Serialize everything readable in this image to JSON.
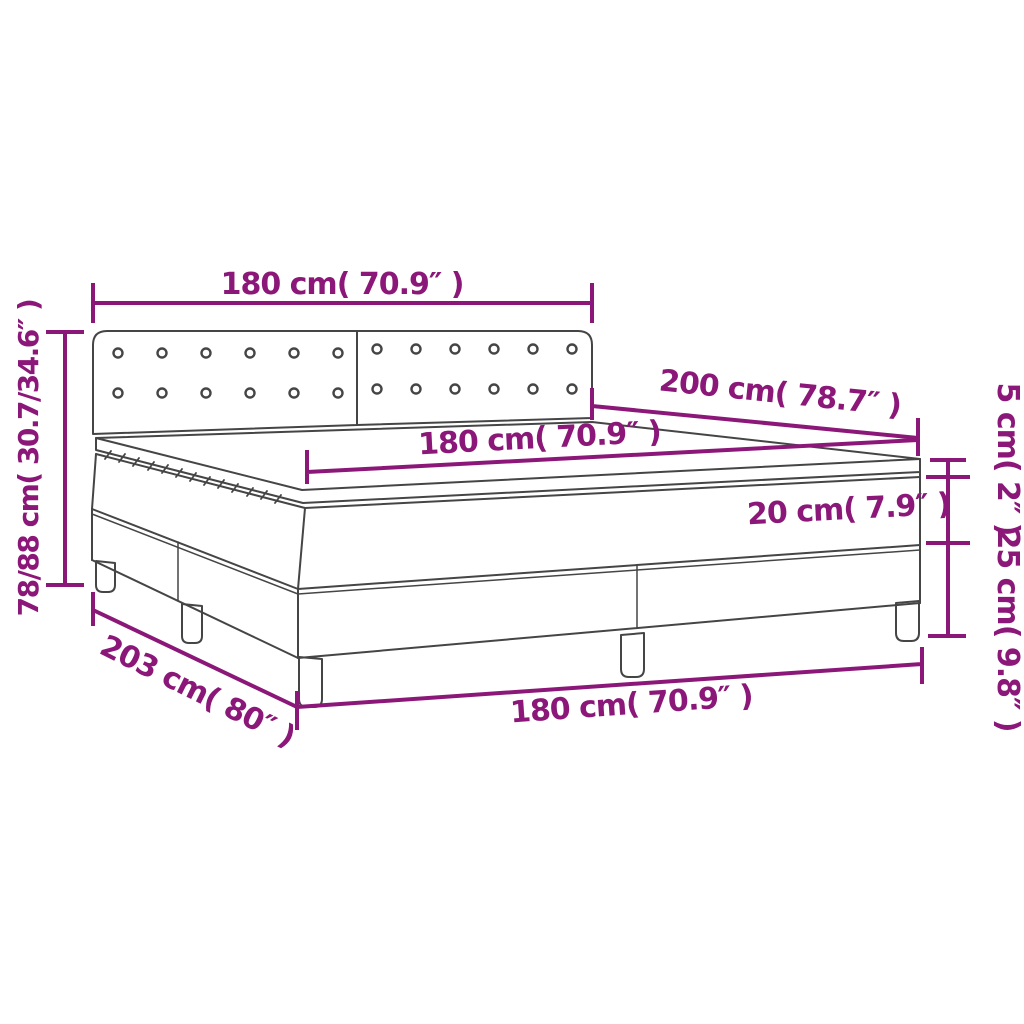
{
  "diagram": {
    "title": "box-spring-bed-dimension-diagram",
    "colors": {
      "dimension": "#8B1879",
      "outline": "#454545",
      "background": "#ffffff"
    },
    "labels": {
      "headboard_width": "180 cm( 70.9″ )",
      "total_height": "78/88 cm( 30.7/34.6″ )",
      "bed_length": "200 cm( 78.7″ )",
      "mattress_width": "180 cm( 70.9″ )",
      "topper_height": "5 cm( 2″ )",
      "mattress_height": "20 cm( 7.9″ )",
      "base_height": "25 cm( 9.8″ )",
      "floor_length": "203 cm( 80″ )",
      "base_width": "180 cm( 70.9″ )"
    },
    "measurements": [
      {
        "id": "headboard-width",
        "cm": "180",
        "inches": "70.9"
      },
      {
        "id": "total-height",
        "cm": "78/88",
        "inches": "30.7/34.6"
      },
      {
        "id": "bed-length",
        "cm": "200",
        "inches": "78.7"
      },
      {
        "id": "mattress-width",
        "cm": "180",
        "inches": "70.9"
      },
      {
        "id": "topper-height",
        "cm": "5",
        "inches": "2"
      },
      {
        "id": "mattress-height",
        "cm": "20",
        "inches": "7.9"
      },
      {
        "id": "base-height",
        "cm": "25",
        "inches": "9.8"
      },
      {
        "id": "floor-length",
        "cm": "203",
        "inches": "80"
      },
      {
        "id": "base-width",
        "cm": "180",
        "inches": "70.9"
      }
    ]
  }
}
